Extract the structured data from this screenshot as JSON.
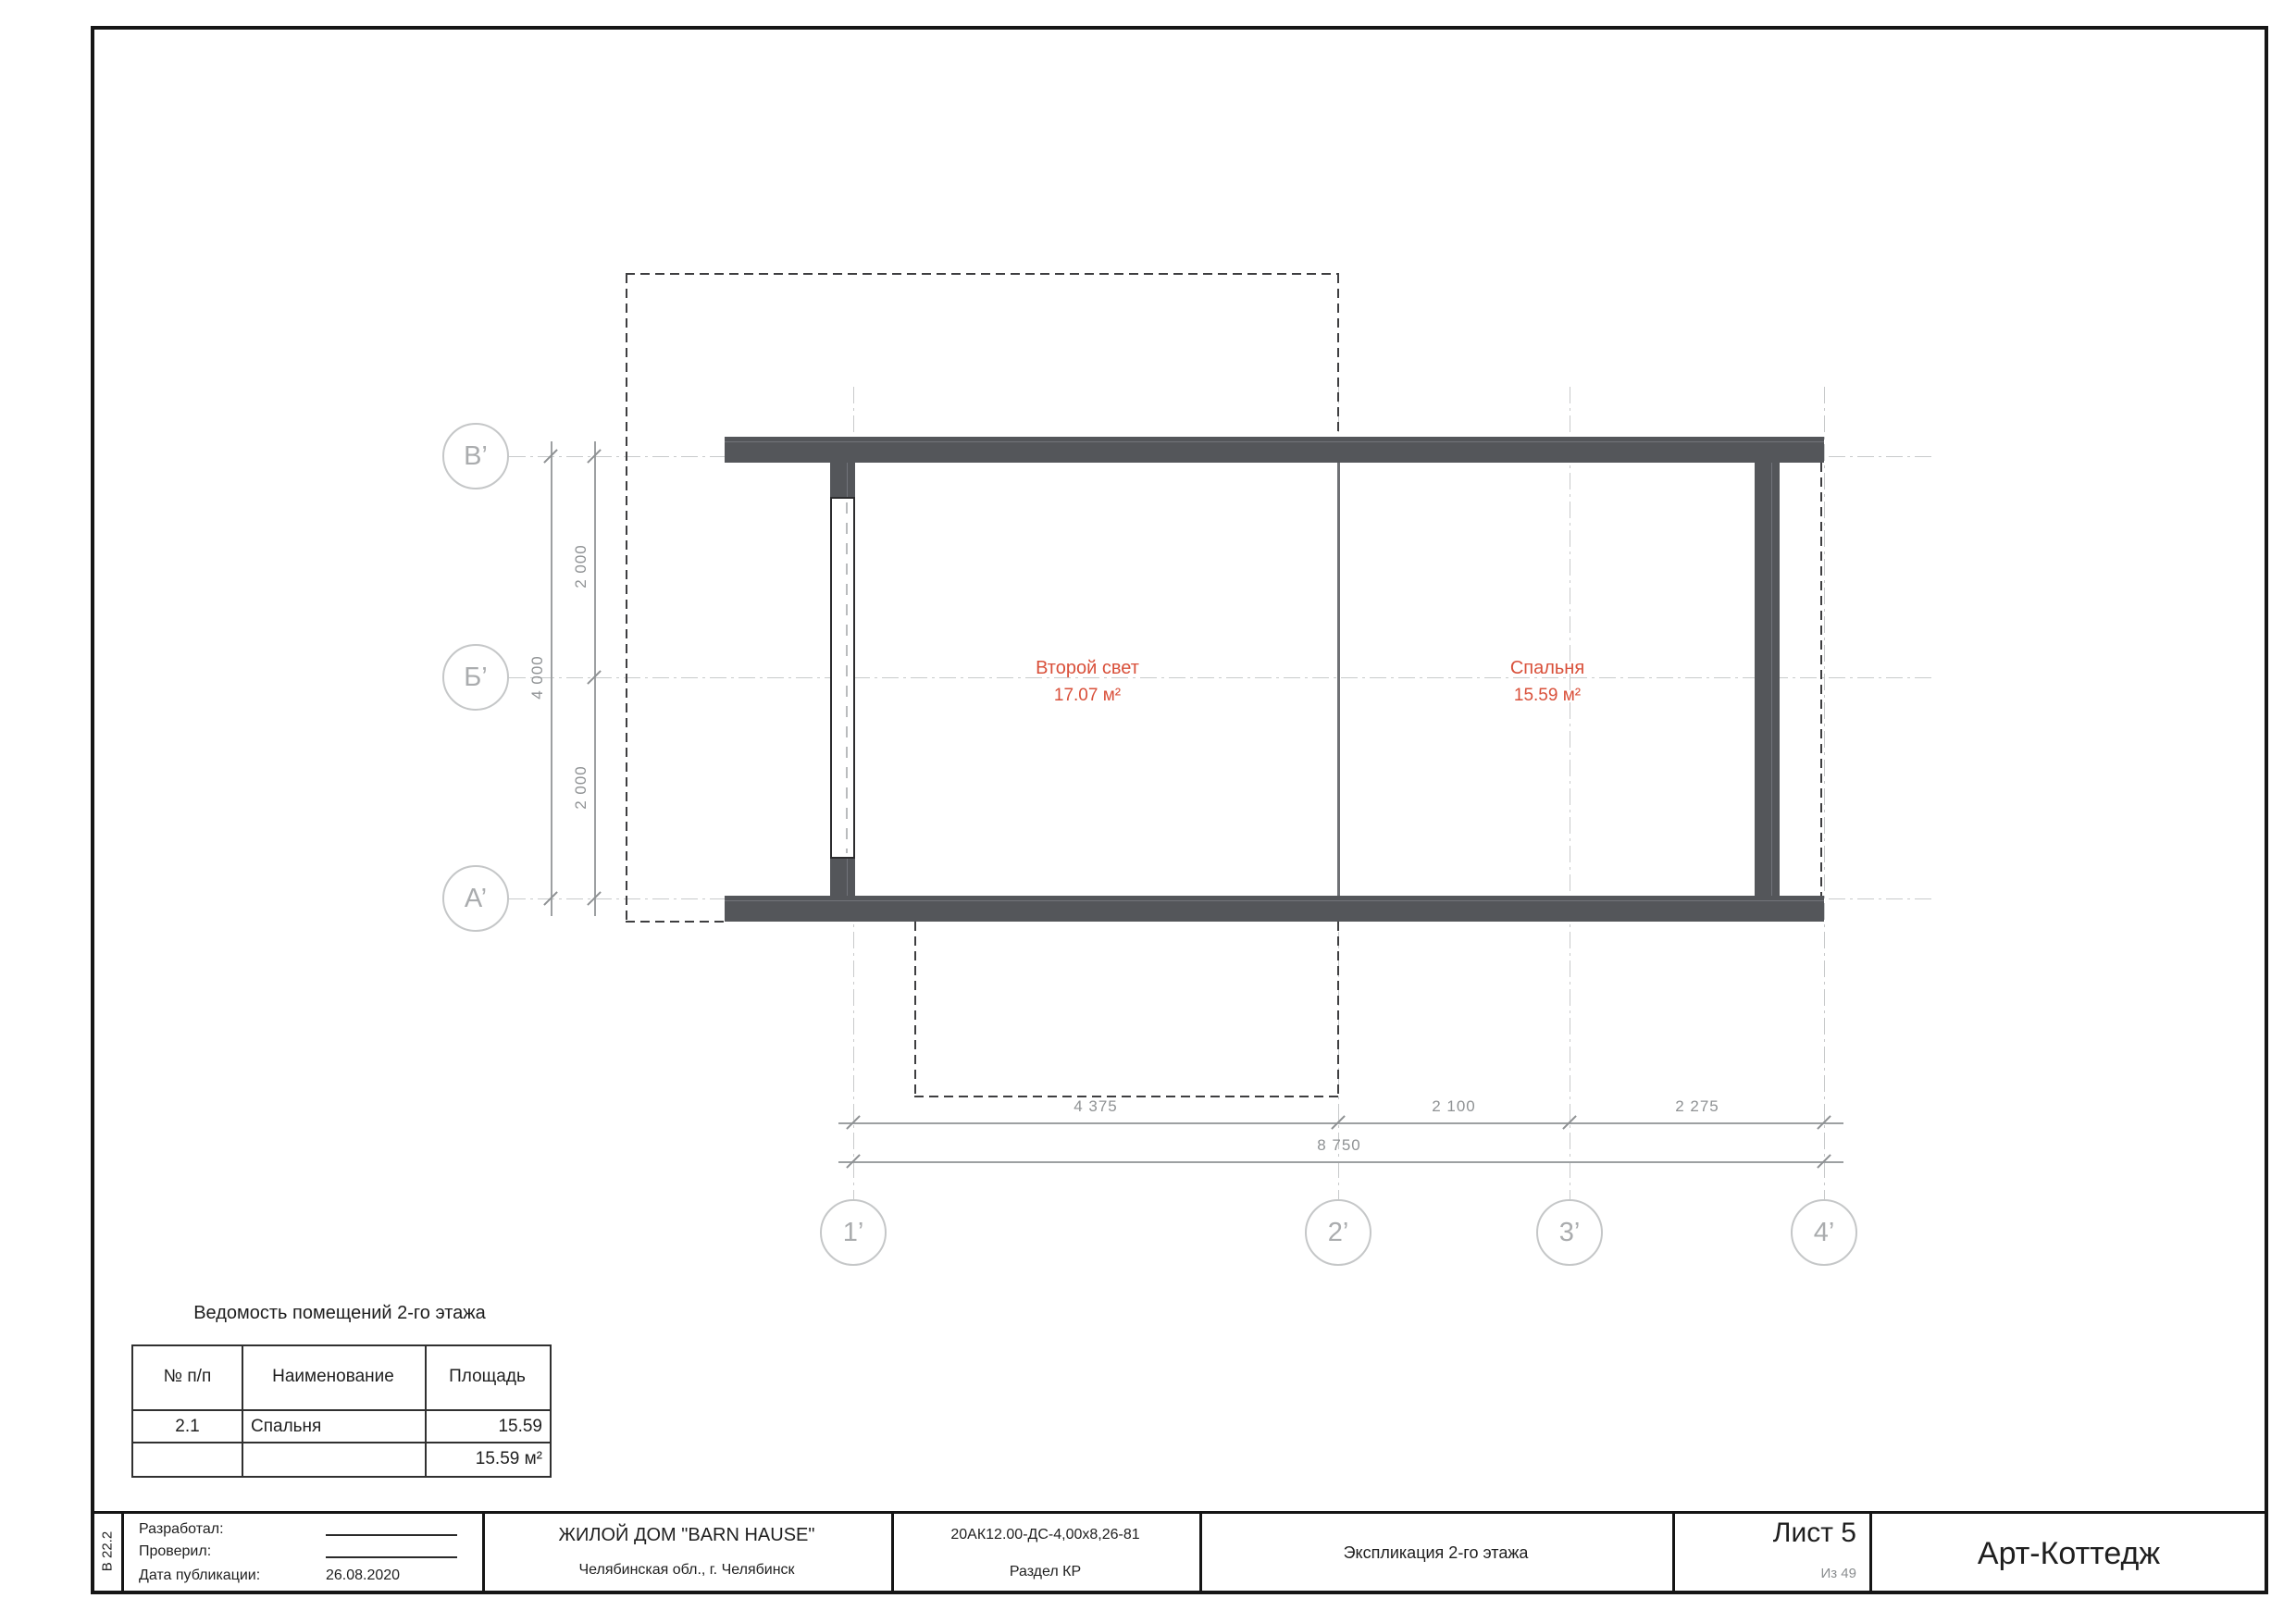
{
  "plan": {
    "rooms": [
      {
        "name": "Второй свет",
        "area": "17.07 м²"
      },
      {
        "name": "Спальня",
        "area": "15.59 м²"
      }
    ],
    "row_axes": [
      {
        "label": "В’"
      },
      {
        "label": "Б’"
      },
      {
        "label": "А’"
      }
    ],
    "col_axes": [
      {
        "label": "1’"
      },
      {
        "label": "2’"
      },
      {
        "label": "3’"
      },
      {
        "label": "4’"
      }
    ],
    "dims_left": {
      "seg1": "2 000",
      "seg2": "2 000",
      "total": "4 000"
    },
    "dims_bottom": {
      "seg1": "4 375",
      "seg2": "2 100",
      "seg3": "2 275",
      "total": "8 750"
    }
  },
  "rooms_table": {
    "title": "Ведомость помещений 2-го этажа",
    "headers": [
      "№ п/п",
      "Наименование",
      "Площадь"
    ],
    "rows": [
      {
        "num": "2.1",
        "name": "Спальня",
        "area": "15.59"
      }
    ],
    "total_area": "15.59 м²"
  },
  "title_block": {
    "stamp_code": "В 22.2",
    "developed_label": "Разработал:",
    "checked_label": "Проверил:",
    "published_label": "Дата публикации:",
    "published_value": "26.08.2020",
    "project_title": "ЖИЛОЙ ДОМ \"BARN HAUSE\"",
    "project_location": "Челябинская обл., г. Челябинск",
    "doc_code": "20АК12.00-ДС-4,00х8,26-81",
    "doc_section": "Раздел КР",
    "sheet_title": "Экспликация 2-го этажа",
    "sheet_label": "Лист 5",
    "sheet_of": "Из 49",
    "brand": "Арт-Коттедж"
  },
  "colors": {
    "room_label": "#d9503a",
    "wall": "#54565a",
    "grid": "#c8cacb"
  }
}
